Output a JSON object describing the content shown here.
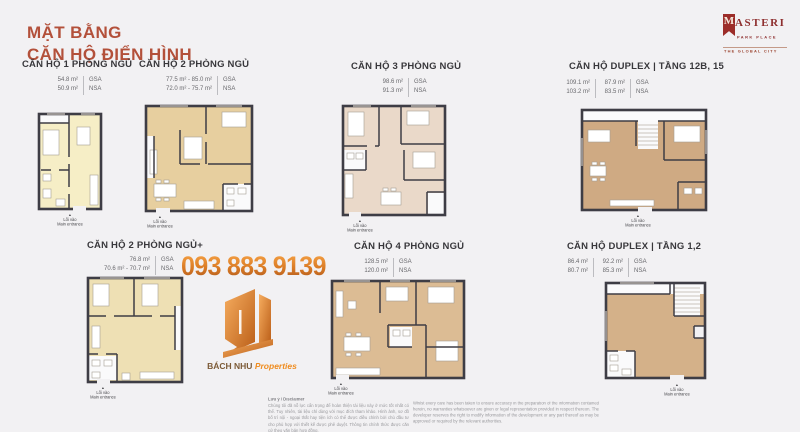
{
  "title": {
    "line1": "MẶT BẰNG",
    "line2": "CĂN HỘ ĐIỂN HÌNH"
  },
  "brand": {
    "initial": "M",
    "rest": "ASTERI",
    "line2": "PARK PLACE",
    "line3": "THE GLOBAL CITY"
  },
  "contact": {
    "phone": "093 883 9139"
  },
  "watermark": {
    "name": "BÁCH NHU",
    "suffix": "Properties"
  },
  "entrance": {
    "arrow": "▲",
    "vi": "Lối vào",
    "en": "Main entrance"
  },
  "area_labels": {
    "gsa": "GSA",
    "nsa": "NSA"
  },
  "colors": {
    "background": "#f2f1f3",
    "title_accent": "#b3503a",
    "brand_red": "#8e2f2f",
    "phone_orange": "#d97a24",
    "walls": "#3e3d45"
  },
  "units": [
    {
      "title": "CĂN HỘ 1 PHÒNG NGỦ",
      "gsa": [
        "54.8 m²"
      ],
      "nsa": [
        "50.9 m²"
      ],
      "color": "#f6eec6"
    },
    {
      "title": "CĂN HỘ 2 PHÒNG NGỦ",
      "gsa": [
        "77.5 m² - 85.0 m²"
      ],
      "nsa": [
        "72.0 m² - 75.7 m²"
      ],
      "color": "#e7cf9f"
    },
    {
      "title": "CĂN HỘ 3 PHÒNG NGỦ",
      "gsa": [
        "98.6 m²"
      ],
      "nsa": [
        "91.3 m²"
      ],
      "color": "#ead9c9"
    },
    {
      "title": "CĂN HỘ DUPLEX |  TẦNG 12B, 15",
      "gsa": [
        "109.1 m²",
        "87.9 m²"
      ],
      "nsa": [
        "103.2 m²",
        "83.5 m²"
      ],
      "color": "#cfaa83"
    },
    {
      "title": "CĂN HỘ 2 PHÒNG NGỦ+",
      "gsa": [
        "76.8 m²"
      ],
      "nsa": [
        "70.6 m² - 70.7 m²"
      ],
      "color": "#eee0b4"
    },
    {
      "title": "CĂN HỘ 4 PHÒNG NGỦ",
      "gsa": [
        "128.5 m²"
      ],
      "nsa": [
        "120.0 m²"
      ],
      "color": "#dcbc94"
    },
    {
      "title": "CĂN HỘ DUPLEX |  TẦNG 1,2",
      "gsa": [
        "86.4 m²",
        "92.2 m²"
      ],
      "nsa": [
        "80.7 m²",
        "85.3 m²"
      ],
      "color": "#d4b189"
    }
  ],
  "disclaimer": {
    "heading": "Lưu ý / Disclaimer",
    "vi": "Chúng tôi đã nỗ lực cẩn trọng để hoàn thiện tài liệu này ở mức tốt nhất có thể. Tuy nhiên, tài liệu chỉ dùng với mục đích tham khảo. Hình ảnh, sơ đồ bố trí nội - ngoại thất hay tiện ích có thể được điều chỉnh bởi chủ đầu tư cho phù hợp với thiết kế được phê duyệt. Thông tin chính thức được căn cứ theo văn bản hợp đồng.",
    "en": "Whilst every care has been taken to ensure accuracy in the preparation of the information contained herein, no warranties whatsoever are given or legal representation provided in respect thereon. The developer reserves the right to modify information of the development or any part thereof as may be approved or required by the relevant authorities."
  }
}
